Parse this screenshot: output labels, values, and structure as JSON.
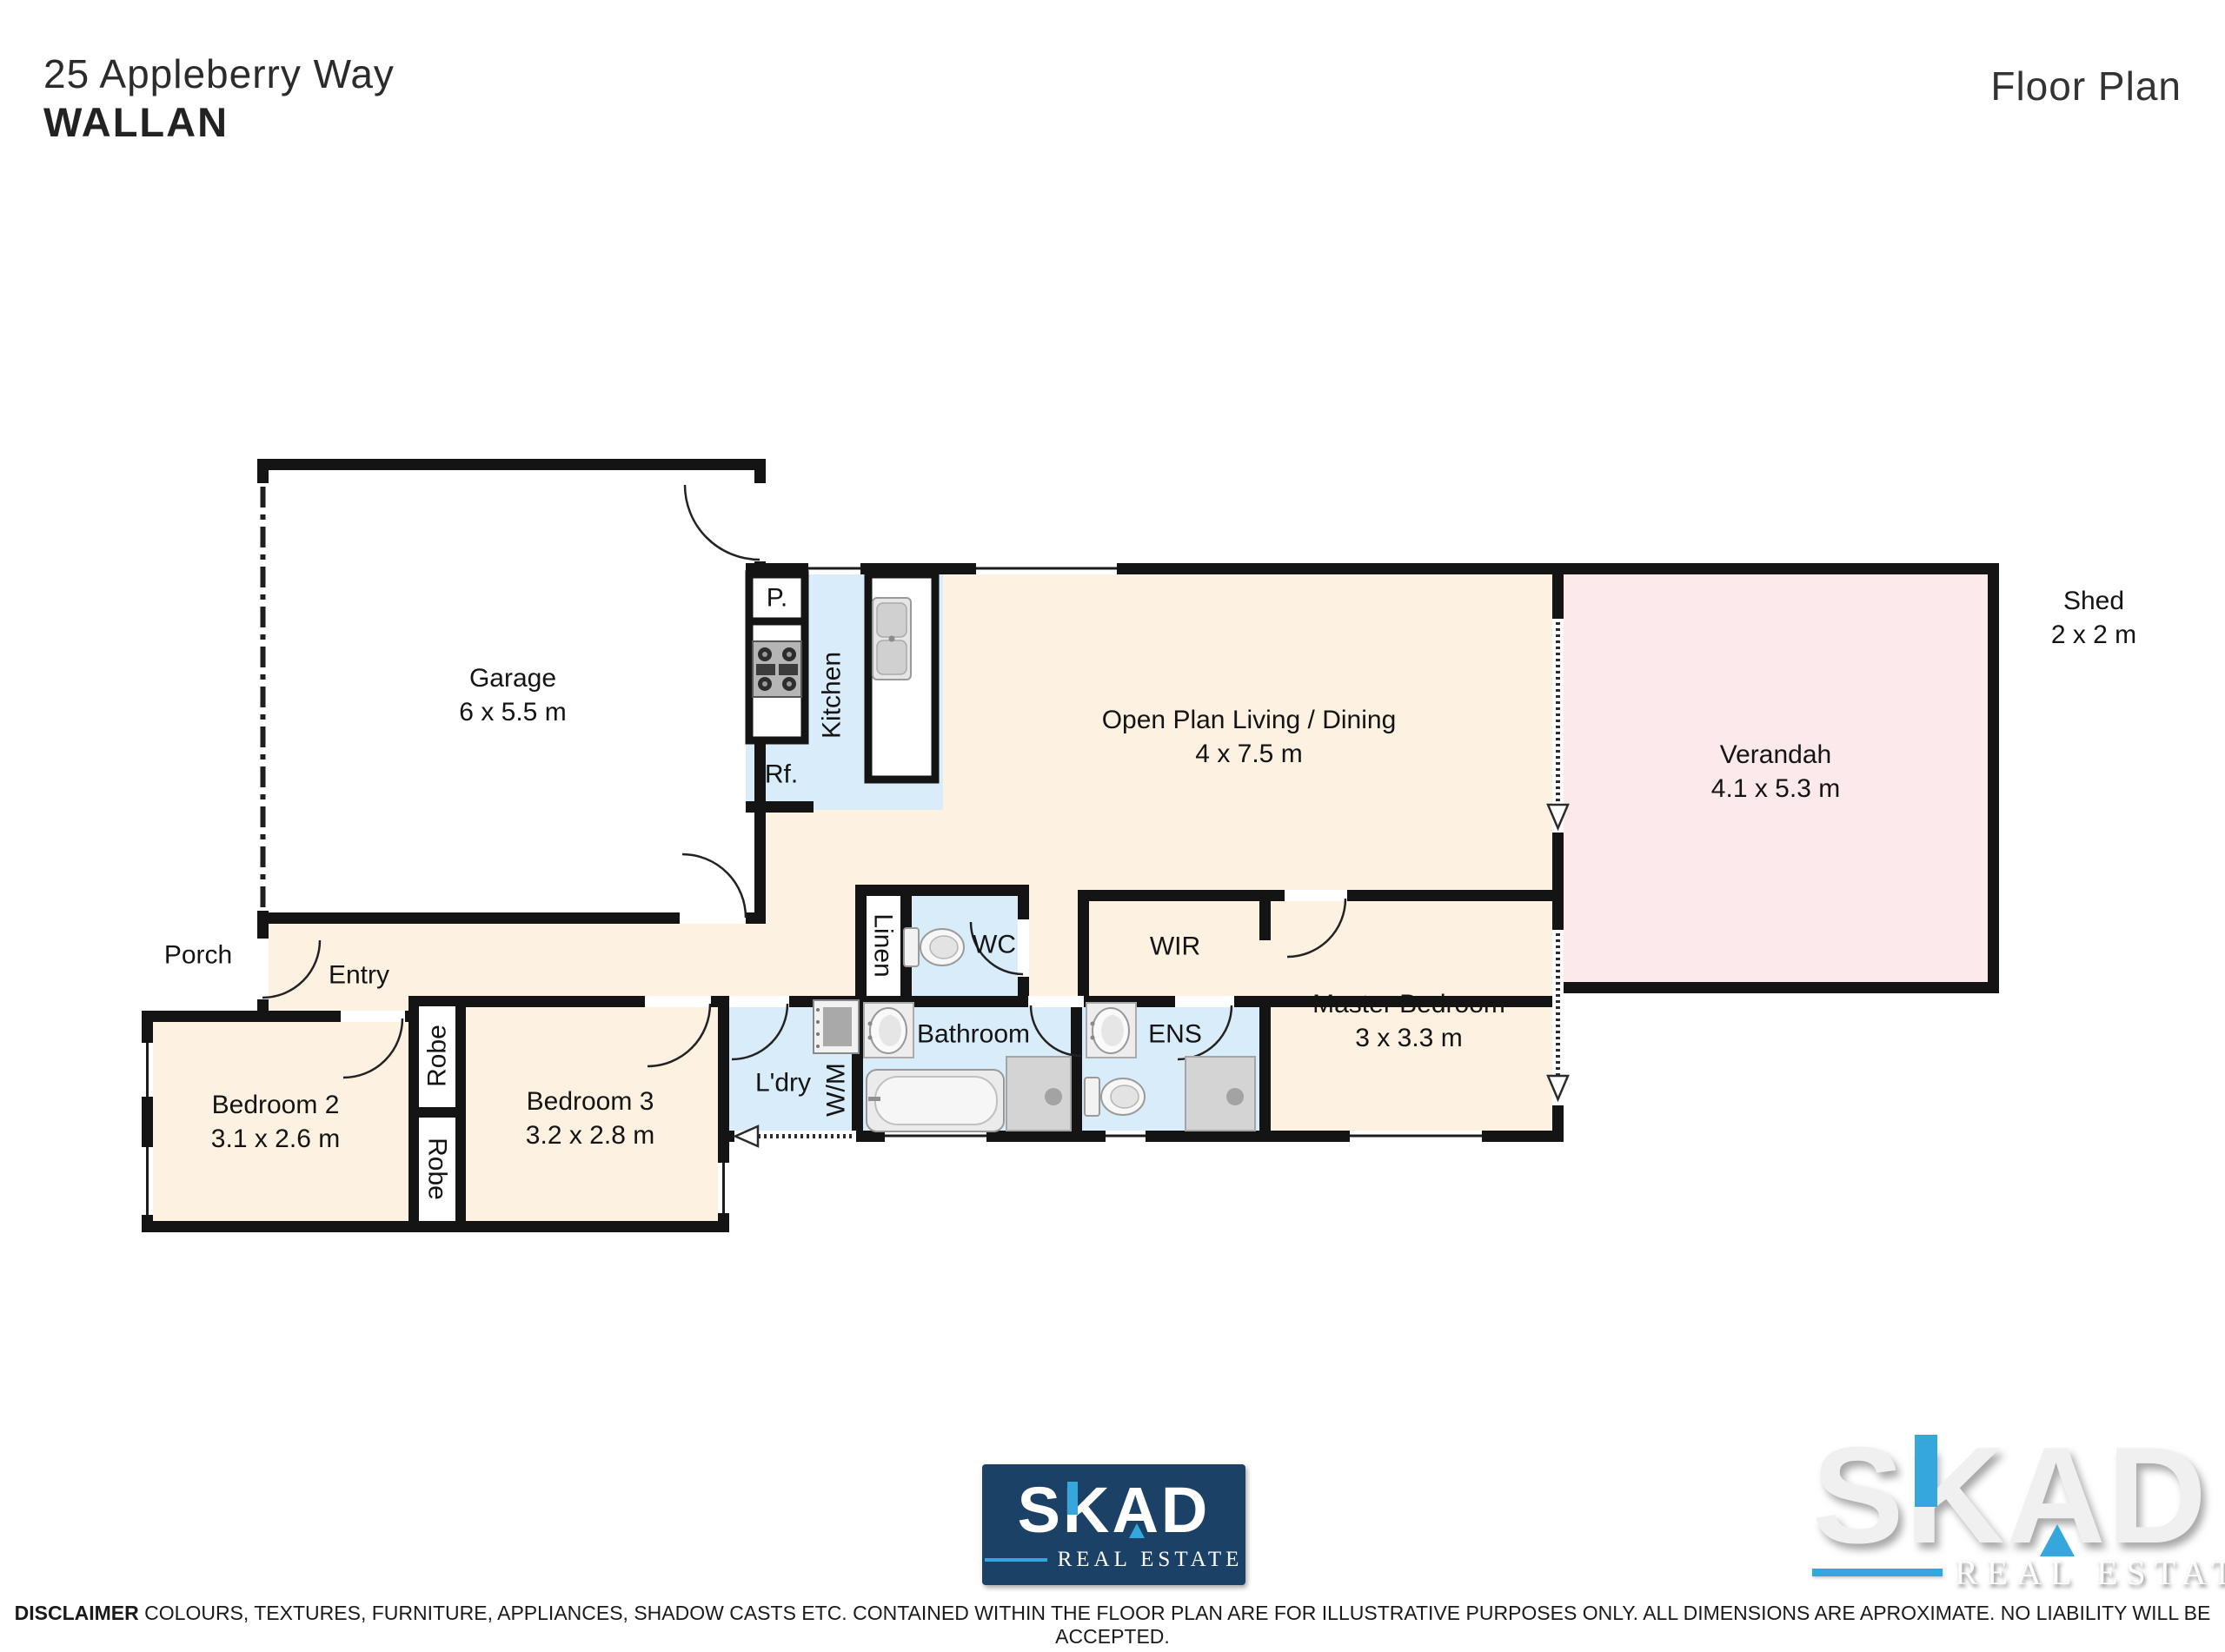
{
  "header": {
    "address_line1": "25 Appleberry Way",
    "address_line2": "WALLAN",
    "page_title": "Floor Plan"
  },
  "rooms": {
    "garage": {
      "name": "Garage",
      "dims": "6 x 5.5 m"
    },
    "kitchen": {
      "name": "Kitchen"
    },
    "pantry": {
      "name": "P."
    },
    "fridge": {
      "name": "Rf."
    },
    "living": {
      "name": "Open Plan Living / Dining",
      "dims": "4 x 7.5 m"
    },
    "verandah": {
      "name": "Verandah",
      "dims": "4.1 x 5.3 m"
    },
    "shed": {
      "name": "Shed",
      "dims": "2 x 2 m"
    },
    "porch": {
      "name": "Porch"
    },
    "entry": {
      "name": "Entry"
    },
    "linen": {
      "name": "Linen"
    },
    "wc": {
      "name": "WC"
    },
    "wir": {
      "name": "WIR"
    },
    "master": {
      "name": "Master Bedroom",
      "dims": "3 x 3.3 m"
    },
    "bathroom": {
      "name": "Bathroom"
    },
    "ens": {
      "name": "ENS"
    },
    "laundry": {
      "name": "L'dry"
    },
    "washer": {
      "name": "W/M"
    },
    "bedroom2": {
      "name": "Bedroom 2",
      "dims": "3.1 x 2.6 m"
    },
    "bedroom3": {
      "name": "Bedroom 3",
      "dims": "3.2 x 2.8 m"
    },
    "robe_top": {
      "name": "Robe"
    },
    "robe_bottom": {
      "name": "Robe"
    }
  },
  "logo": {
    "letters": [
      "S",
      "K",
      "A",
      "D"
    ],
    "tagline": "REAL ESTATE"
  },
  "footer": {
    "disclaimer_label": "DISCLAIMER",
    "disclaimer_text": " COLOURS, TEXTURES, FURNITURE, APPLIANCES, SHADOW CASTS ETC. CONTAINED WITHIN THE FLOOR PLAN ARE FOR ILLUSTRATIVE PURPOSES ONLY. ALL DIMENSIONS ARE APROXIMATE. NO LIABILITY WILL BE ACCEPTED."
  },
  "colors": {
    "floor_beige": "#fdf1e2",
    "wet_blue": "#d8ecf9",
    "verandah_pink": "#fbe9ec",
    "wall_black": "#141414",
    "brand_navy": "#1c4166",
    "brand_blue": "#35a7dd"
  }
}
